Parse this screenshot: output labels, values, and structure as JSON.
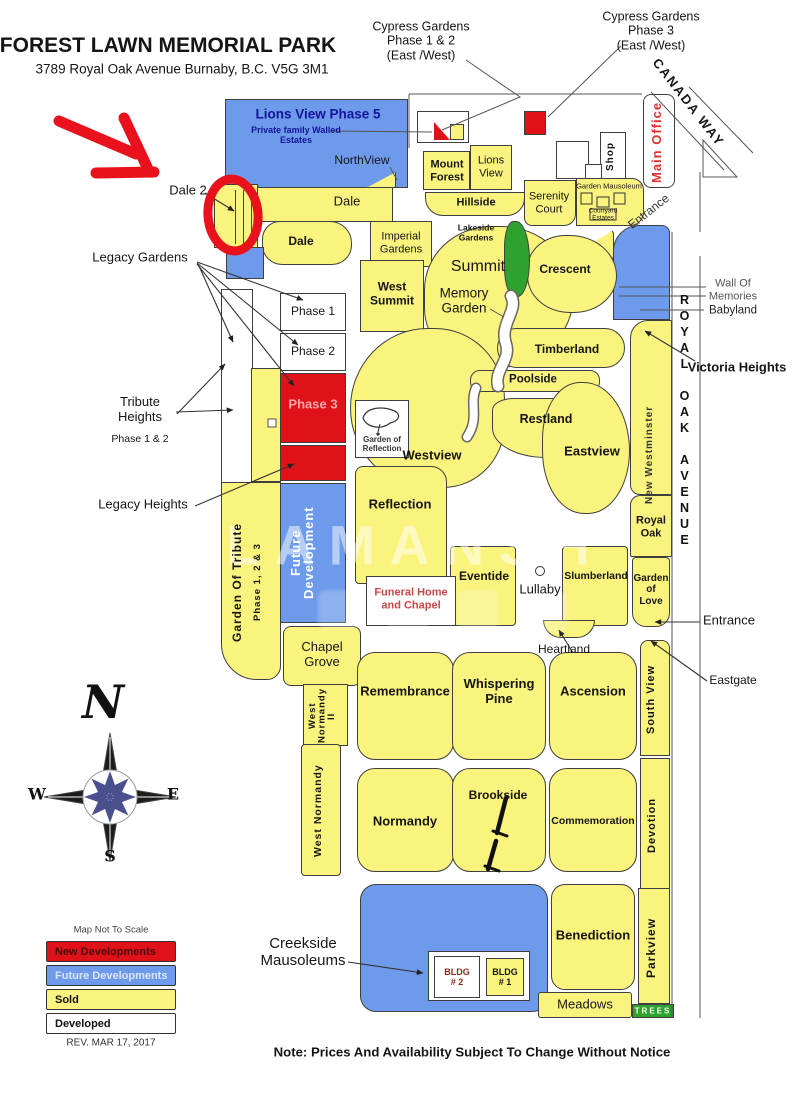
{
  "header": {
    "title": "FOREST LAWN MEMORIAL PARK",
    "address": "3789 Royal Oak Avenue  Burnaby, B.C.  V5G 3M1"
  },
  "callouts": {
    "cypress12": "Cypress Gardens\nPhase 1 & 2\n(East /West)",
    "cypress3": "Cypress Gardens\nPhase 3\n(East /West)",
    "canada_way": "CANADA WAY",
    "entrance_top": "Entrance",
    "dale2": "Dale 2",
    "legacy_gardens": "Legacy Gardens",
    "tribute_heights": "Tribute\nHeights",
    "tribute_heights_sub": "Phase 1 & 2",
    "legacy_heights": "Legacy Heights",
    "wall_of_memories": "Wall Of\nMemories",
    "babyland": "Babyland",
    "victoria_heights": "Victoria Heights",
    "royal_oak_avenue": "ROYAL OAK AVENUE",
    "entrance_east": "Entrance",
    "eastgate": "Eastgate",
    "creekside": "Creekside\nMausoleums",
    "note": "Note: Prices And Availability Subject To Change Without Notice",
    "watermark": "LAMANSH"
  },
  "regions": {
    "lions_view_phase5": "Lions View Phase 5",
    "lions_view_phase5_sub": "Private family Walled\nEstates",
    "northview": "NorthView",
    "mount_forest": "Mount\nForest",
    "lions_view": "Lions\nView",
    "hillside": "Hillside",
    "serenity_court": "Serenity\nCourt",
    "garden_mausoleum": "Garden Mausoleum",
    "courtyard_estates": "Courtyard\nEstates",
    "main_office": "Main Office",
    "shop": "Shop",
    "dale_strip": "Dale",
    "dale": "Dale",
    "imperial_gardens": "Imperial\nGardens",
    "lakeside_gardens": "Lakeside\nGardens",
    "summit": "Summit",
    "memory_garden": "Memory\nGarden",
    "crescent": "Crescent",
    "west_summit": "West\nSummit",
    "phase1": "Phase  1",
    "phase2": "Phase  2",
    "phase3": "Phase  3",
    "timberland": "Timberland",
    "poolside": "Poolside",
    "new_westminster": "New Westminster",
    "garden_of_reflection": "Garden of\nReflection",
    "restland": "Restland",
    "westview": "Westview",
    "eastview": "Eastview",
    "reflection": "Reflection",
    "royal_oak": "Royal\nOak",
    "future_development": "Future\nDevelopment",
    "garden_of_tribute": "Garden Of Tribute",
    "garden_of_tribute_sub": "Phase 1, 2 & 3",
    "eventide": "Eventide",
    "lullaby": "Lullaby",
    "slumberland": "Slumberland",
    "garden_of_love": "Garden\nof\nLove",
    "funeral_home": "Funeral Home\nand Chapel",
    "chapel_grove": "Chapel\nGrove",
    "heartland": "Heartland",
    "west_normandy_ii": "West\nNormandy\nII",
    "remembrance": "Remembrance",
    "whispering_pine": "Whispering\nPine",
    "ascension": "Ascension",
    "south_view": "South View",
    "west_normandy": "West Normandy",
    "normandy": "Normandy",
    "brookside": "Brookside",
    "commemoration": "Commemoration",
    "devotion": "Devotion",
    "bldg2": "BLDG\n# 2",
    "bldg1": "BLDG\n# 1",
    "benediction": "Benediction",
    "meadows": "Meadows",
    "parkview": "Parkview",
    "trees": "TREES"
  },
  "compass": {
    "n": "N",
    "w": "W",
    "e": "E",
    "s": "S"
  },
  "legend": {
    "scale_note": "Map Not To Scale",
    "items": [
      {
        "label": "New Developments",
        "color": "#E01219",
        "text_color": "#4A0A0A"
      },
      {
        "label": "Future Developments",
        "color": "#6D9AEA",
        "text_color": "#DCE6FF"
      },
      {
        "label": "Sold",
        "color": "#FAF37E",
        "text_color": "#111111"
      },
      {
        "label": "Developed",
        "color": "#FFFFFF",
        "text_color": "#111111"
      }
    ],
    "revision": "REV. MAR 17, 2017"
  },
  "colors": {
    "sold_yellow": "#FAF37E",
    "future_blue": "#6D9AEA",
    "new_red": "#E01219",
    "grass_green": "#2FA12E",
    "annotation_red": "#E8111C",
    "office_text_red": "#E03030",
    "funeral_text_red": "#C94747"
  }
}
